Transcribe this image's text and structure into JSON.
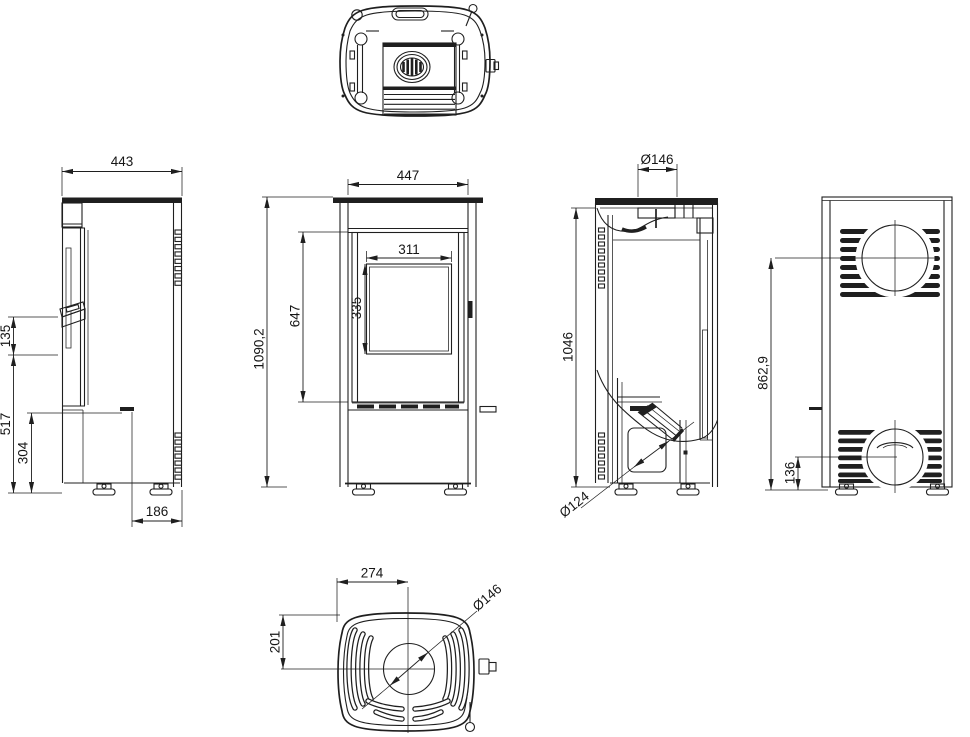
{
  "drawing": {
    "background": "#ffffff",
    "line_color": "#1f1f1f"
  },
  "dims": {
    "side_width": "443",
    "side_handle_height": "135",
    "side_lower_height": "517",
    "side_base_height": "304",
    "side_base_depth": "186",
    "front_width": "447",
    "front_total_height": "1090,2",
    "front_door_height": "647",
    "front_glass_width": "311",
    "front_glass_height": "335",
    "section_flue_diameter": "Ø146",
    "section_height": "1046",
    "section_pipe_diameter": "Ø124",
    "back_flue_center_height": "862,9",
    "back_outlet_center_height": "136",
    "bottom_center_offset_width": "274",
    "bottom_center_offset_depth": "201",
    "bottom_opening_diameter": "Ø146"
  }
}
